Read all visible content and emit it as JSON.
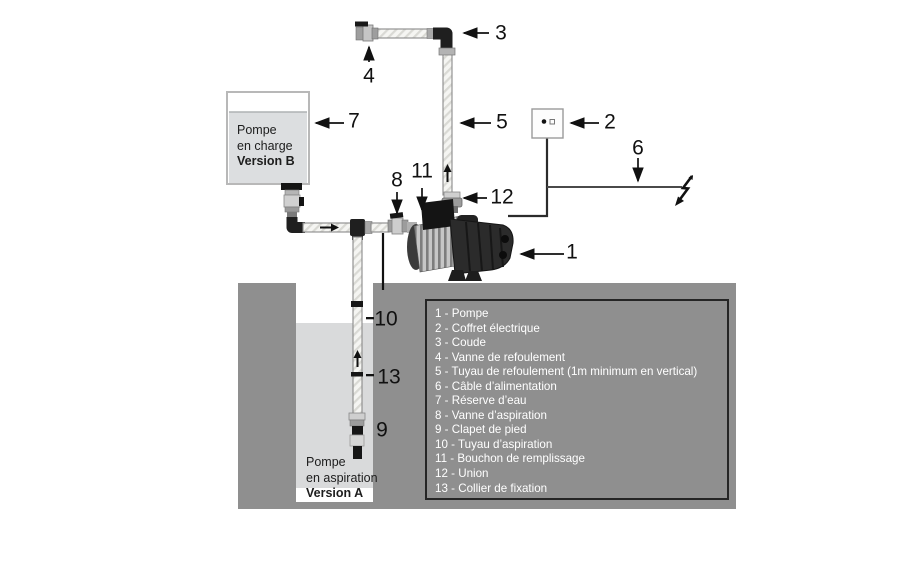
{
  "diagram_title": "pump-installation-diagram",
  "colors": {
    "ground": "#8f8f8f",
    "well_water": "#d9dadb",
    "tank_fill": "#dcdee0",
    "legend_background": "#8f8f8f",
    "legend_text": "#ffffff",
    "line": "#111111"
  },
  "tank_b": {
    "line1": "Pompe",
    "line2": "en charge",
    "line3": "Version B"
  },
  "version_a": {
    "line1": "Pompe",
    "line2": "en aspiration",
    "line3": "Version A"
  },
  "callouts": {
    "c1": "1",
    "c2": "2",
    "c3": "3",
    "c4": "4",
    "c5": "5",
    "c6": "6",
    "c7": "7",
    "c8": "8",
    "c9": "9",
    "c10": "10",
    "c11": "11",
    "c12": "12",
    "c13": "13"
  },
  "legend": {
    "items": [
      "1 - Pompe",
      "2 - Coffret électrique",
      "3 - Coude",
      "4 - Vanne de refoulement",
      "5 - Tuyau de refoulement (1m minimum en vertical)",
      "6 - Câble d’alimentation",
      "7 - Réserve d’eau",
      "8 - Vanne d’aspiration",
      "9 - Clapet de pied",
      "10 - Tuyau d’aspiration",
      "11 - Bouchon de remplissage",
      "12 - Union",
      "13 - Collier de fixation"
    ]
  }
}
